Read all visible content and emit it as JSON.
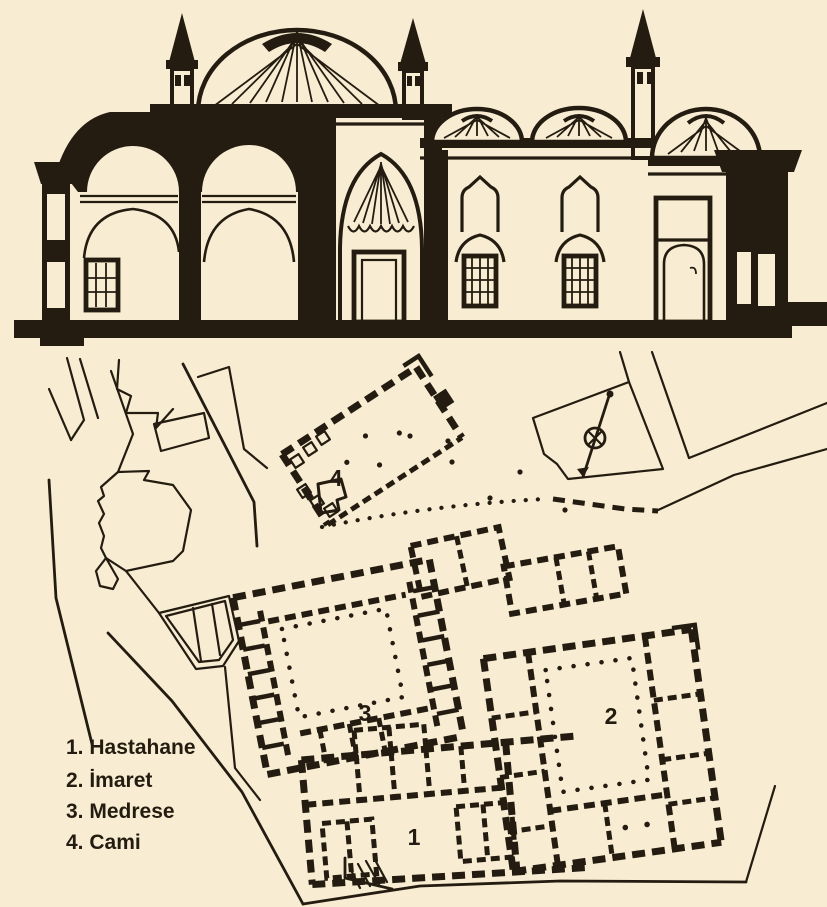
{
  "palette": {
    "paper": "#f8edd3",
    "ink": "#241c10"
  },
  "plan": {
    "building_labels": [
      "1",
      "2",
      "3",
      "4"
    ],
    "legend": [
      "1. Hastahane",
      "2. İmaret",
      "3. Medrese",
      "4. Cami"
    ]
  }
}
